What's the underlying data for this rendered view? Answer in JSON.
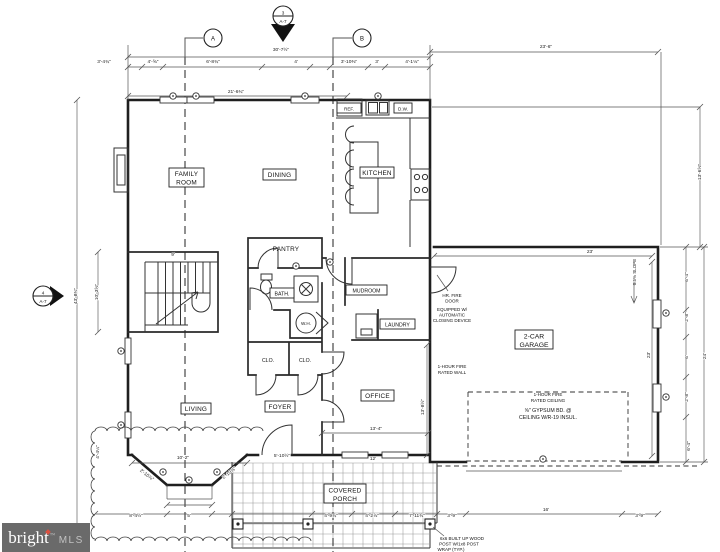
{
  "watermark": {
    "brand": "bright",
    "suffix": "MLS",
    "tm": "™"
  },
  "markers": {
    "top": {
      "num": "3",
      "sheet": "A-7"
    },
    "left": {
      "num": "4",
      "sheet": "A-7"
    },
    "col_a": "A",
    "col_b": "B"
  },
  "rooms": {
    "family": [
      "FAMILY",
      "ROOM"
    ],
    "dining": "DINING",
    "kitchen": "KITCHEN",
    "pantry": "PANTRY",
    "bath": "BATH.",
    "mudroom": "MUDROOM",
    "laundry": "LAUNDRY",
    "water_heater": "W.H.",
    "closet1": "CLO.",
    "closet2": "CLO.",
    "living": "LIVING",
    "foyer": "FOYER",
    "office": "OFFICE",
    "garage": [
      "2-CAR",
      "GARAGE"
    ],
    "porch": [
      "COVERED",
      "PORCH"
    ],
    "fridge": "REF.",
    "dishwasher": "D.W."
  },
  "notes": {
    "fire_door": [
      "HR. FIRE",
      "DOOR",
      "EQUIPPED W/",
      "AUTOMATIC",
      "CLOSING DEVICE"
    ],
    "fire_wall": [
      "1-HOUR FIRE",
      "RATED WALL"
    ],
    "fire_ceiling": [
      "1-HOUR FIRE",
      "RATED CEILING"
    ],
    "gypsum": [
      "⅝\" GYPSUM BD. @",
      "CEILING W/R-19 INSUL."
    ],
    "slope": "0.5% SLOPE",
    "post": [
      "6x6 BUILT UP WOOD",
      "POST W/1x8 POST",
      "WRAP (TYP.)"
    ]
  },
  "dimensions": [
    {
      "x": 281,
      "y": 51,
      "t": "30'-7½\""
    },
    {
      "x": 546,
      "y": 48,
      "t": "23'-6\""
    },
    {
      "x": 104,
      "y": 63,
      "t": "3'-4¾\""
    },
    {
      "x": 153,
      "y": 63,
      "t": "4'-⅝\""
    },
    {
      "x": 213,
      "y": 63,
      "t": "6'-8¾\""
    },
    {
      "x": 296,
      "y": 63,
      "t": "4'"
    },
    {
      "x": 349,
      "y": 63,
      "t": "3'-10⅜\""
    },
    {
      "x": 377,
      "y": 63,
      "t": "3'"
    },
    {
      "x": 412,
      "y": 63,
      "t": "4'-1⅛\""
    },
    {
      "x": 236,
      "y": 93,
      "t": "21'-6¾\""
    },
    {
      "x": 77,
      "y": 296,
      "t": "43'-8¾\"",
      "r": -90
    },
    {
      "x": 98,
      "y": 292,
      "t": "10'-3⅝\"",
      "r": -90
    },
    {
      "x": 173,
      "y": 256,
      "t": "9'"
    },
    {
      "x": 701,
      "y": 172,
      "t": "13'-6⅝\"",
      "r": -90
    },
    {
      "x": 706,
      "y": 356,
      "t": "24'",
      "r": -90
    },
    {
      "x": 688,
      "y": 277,
      "t": "6'-4\"",
      "r": -90
    },
    {
      "x": 688,
      "y": 317,
      "t": "2'-8\"",
      "r": -90
    },
    {
      "x": 688,
      "y": 357,
      "t": "6'",
      "r": -90
    },
    {
      "x": 688,
      "y": 397,
      "t": "2'-8\"",
      "r": -90
    },
    {
      "x": 650,
      "y": 355,
      "t": "23'",
      "r": -90
    },
    {
      "x": 590,
      "y": 253,
      "t": "23'"
    },
    {
      "x": 376,
      "y": 430,
      "t": "13'-4\""
    },
    {
      "x": 424,
      "y": 407,
      "t": "13'-8½\"",
      "r": -90
    },
    {
      "x": 373,
      "y": 460,
      "t": "12'"
    },
    {
      "x": 282,
      "y": 457,
      "t": "5'-10½\""
    },
    {
      "x": 183,
      "y": 459,
      "t": "10'-2\""
    },
    {
      "x": 136,
      "y": 517,
      "t": "8'-4½\""
    },
    {
      "x": 189,
      "y": 517,
      "t": "5'"
    },
    {
      "x": 146,
      "y": 476,
      "t": "2'-10⅞\"",
      "r": 38
    },
    {
      "x": 230,
      "y": 474,
      "t": "2'-10⅞\"",
      "r": -38
    },
    {
      "x": 99,
      "y": 452,
      "t": "4'-4¼\"",
      "r": -90
    },
    {
      "x": 331,
      "y": 517,
      "t": "4'-9¾\""
    },
    {
      "x": 372,
      "y": 517,
      "t": "4'-2⅞\""
    },
    {
      "x": 417,
      "y": 517,
      "t": "7'-11¾\""
    },
    {
      "x": 452,
      "y": 517,
      "t": "3'-9\""
    },
    {
      "x": 546,
      "y": 511,
      "t": "16'"
    },
    {
      "x": 640,
      "y": 517,
      "t": "3'-9\""
    },
    {
      "x": 690,
      "y": 446,
      "t": "6'-4\"",
      "r": -90
    }
  ]
}
